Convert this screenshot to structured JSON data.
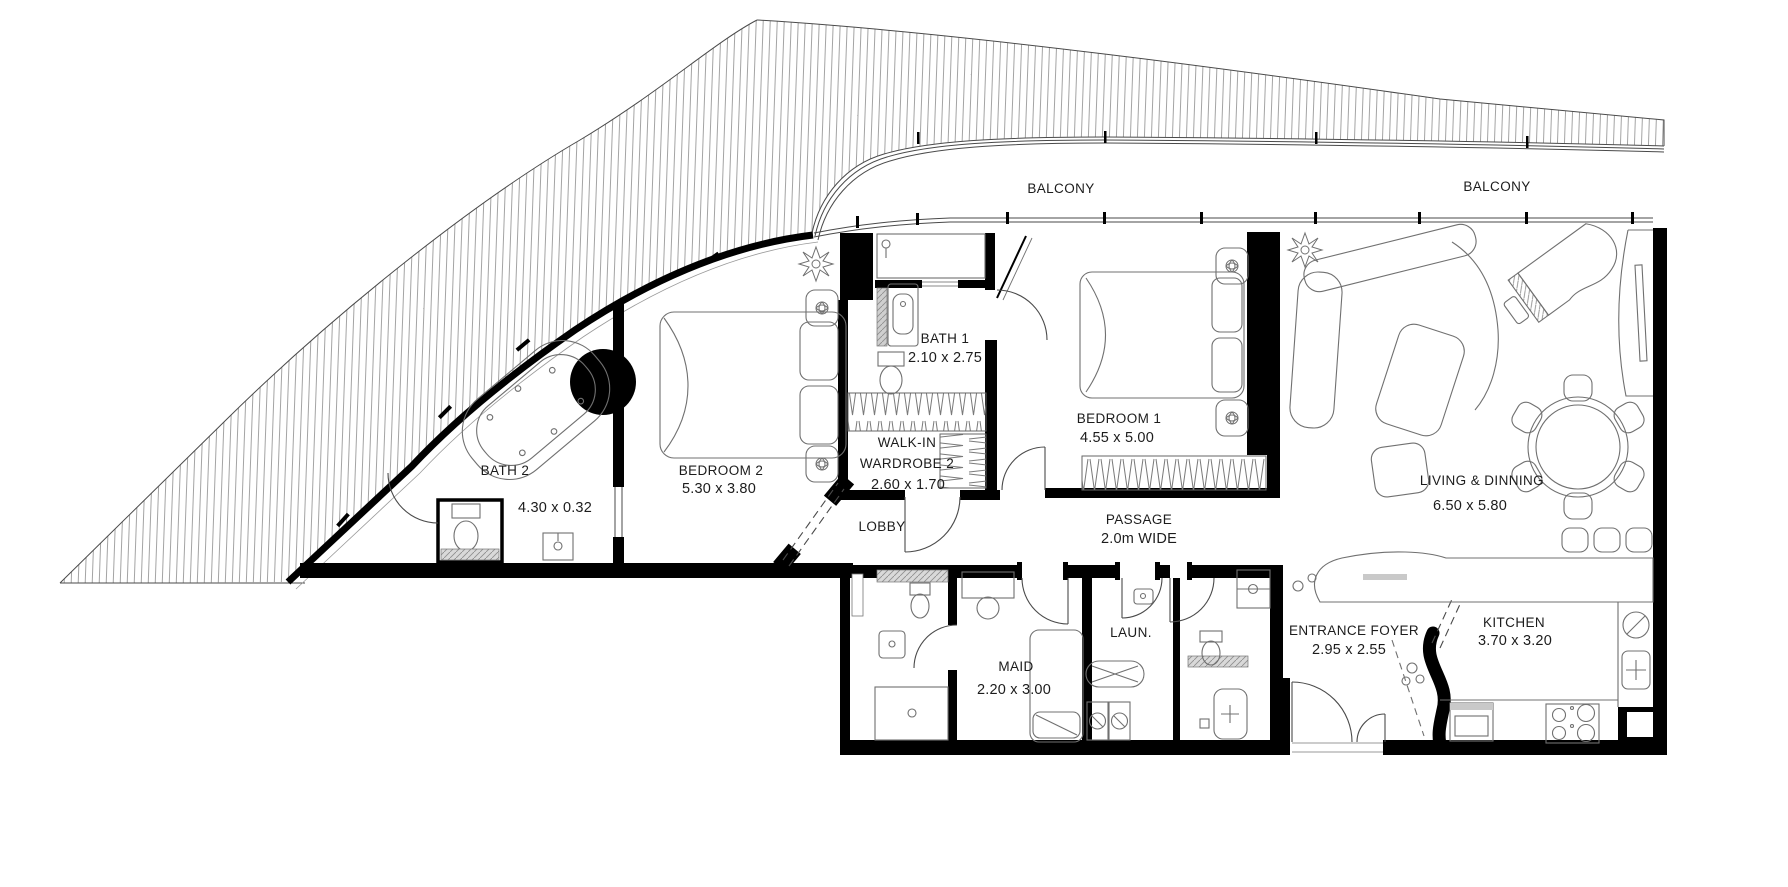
{
  "plan": {
    "balcony": {
      "left": "BALCONY",
      "right": "BALCONY"
    },
    "rooms": {
      "bath1": {
        "name": "BATH 1",
        "dims": "2.10 x 2.75"
      },
      "walkin": {
        "line1": "WALK-IN",
        "line2": "WARDROBE 2",
        "dims": "2.60 x 1.70"
      },
      "bedroom1": {
        "name": "BEDROOM 1",
        "dims": "4.55 x 5.00"
      },
      "bedroom2": {
        "name": "BEDROOM 2",
        "dims": "5.30 x 3.80"
      },
      "bath2": {
        "name": "BATH 2",
        "dims": "4.30 x 0.32"
      },
      "lobby": {
        "name": "LOBBY"
      },
      "passage": {
        "name": "PASSAGE",
        "dims": "2.0m WIDE"
      },
      "maid": {
        "name": "MAID",
        "dims": "2.20 x 3.00"
      },
      "laundry": {
        "name": "LAUN."
      },
      "foyer": {
        "name": "ENTRANCE FOYER",
        "dims": "2.95 x 2.55"
      },
      "kitchen": {
        "name": "KITCHEN",
        "dims": "3.70 x 3.20"
      },
      "living": {
        "name": "LIVING & DINNING",
        "dims": "6.50 x 5.80"
      }
    },
    "colors": {
      "walls": "#000000",
      "hatch_lines": "#8c8c8c",
      "furniture_lines": "#707070",
      "text": "#1c1c1c",
      "background": "#ffffff"
    }
  }
}
